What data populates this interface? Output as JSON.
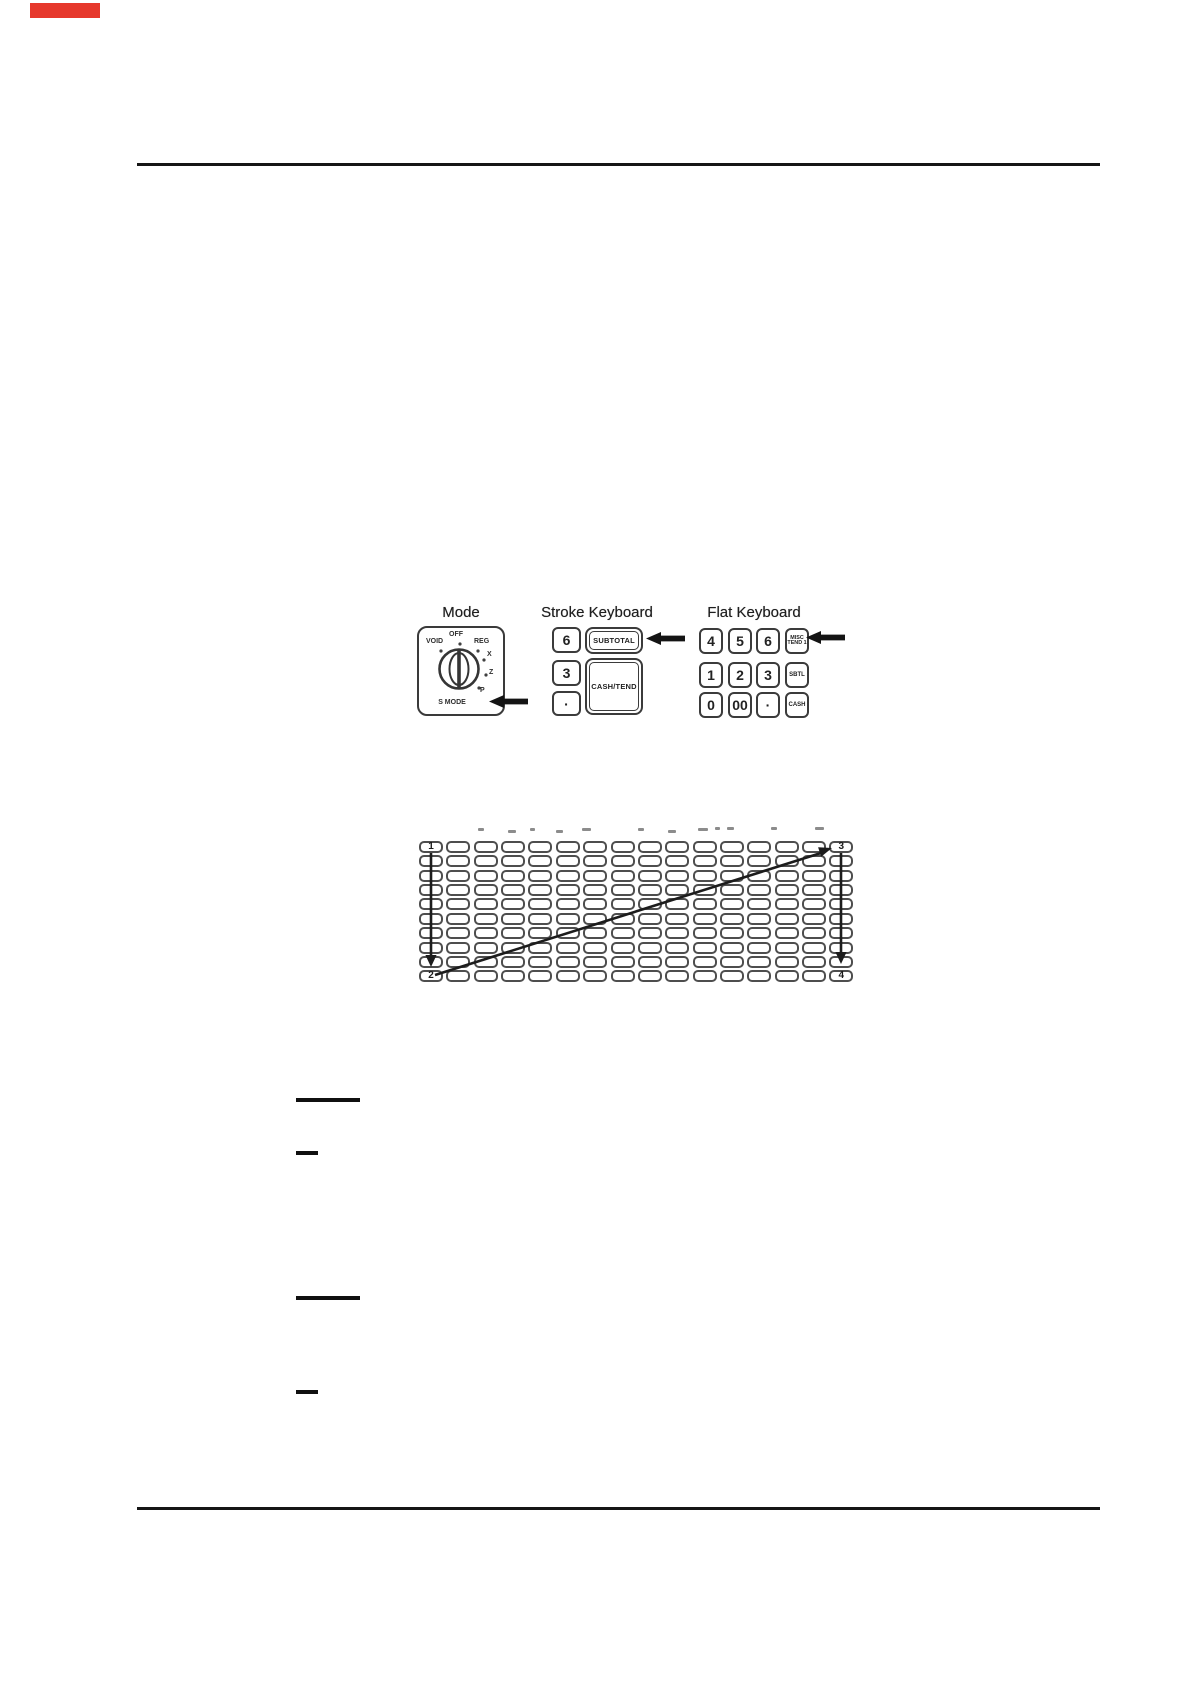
{
  "colors": {
    "accent_marker": "#e6382c",
    "rule_line": "#161616"
  },
  "figures": {
    "keyboards": {
      "mode": {
        "title": "Mode",
        "labels": {
          "void": "VOID",
          "off": "OFF",
          "reg": "REG",
          "x": "X",
          "z": "Z",
          "p": "P",
          "s_mode": "S MODE"
        }
      },
      "stroke": {
        "title": "Stroke Keyboard",
        "left_keys": [
          "6",
          "3",
          "·"
        ],
        "subtotal_key": "SUBTOTAL",
        "cash_tend_key": "CASH/TEND"
      },
      "flat": {
        "title": "Flat Keyboard",
        "rows": [
          [
            {
              "label": "4"
            },
            {
              "label": "5"
            },
            {
              "label": "6"
            },
            {
              "label": "MISC TEND 1",
              "lines": [
                "MISC",
                "TEND 1"
              ],
              "small": true
            }
          ],
          [
            {
              "label": "1"
            },
            {
              "label": "2"
            },
            {
              "label": "3"
            },
            {
              "label": "SBTL",
              "small": true
            }
          ],
          [
            {
              "label": "0"
            },
            {
              "label": "00"
            },
            {
              "label": "·"
            },
            {
              "label": "CASH",
              "small": true
            }
          ]
        ]
      }
    },
    "key_layout_grid": {
      "columns": 16,
      "rows": 10,
      "corner_labels": {
        "top_left": "1",
        "bottom_left": "2",
        "top_right": "3",
        "bottom_right": "4"
      },
      "smudges": [
        [
          59,
          6
        ],
        [
          89,
          8
        ],
        [
          111,
          5
        ],
        [
          137,
          7
        ],
        [
          163,
          9
        ],
        [
          219,
          6
        ],
        [
          249,
          8
        ],
        [
          279,
          10
        ],
        [
          296,
          5
        ],
        [
          308,
          7
        ],
        [
          352,
          6
        ],
        [
          396,
          9
        ]
      ]
    }
  }
}
